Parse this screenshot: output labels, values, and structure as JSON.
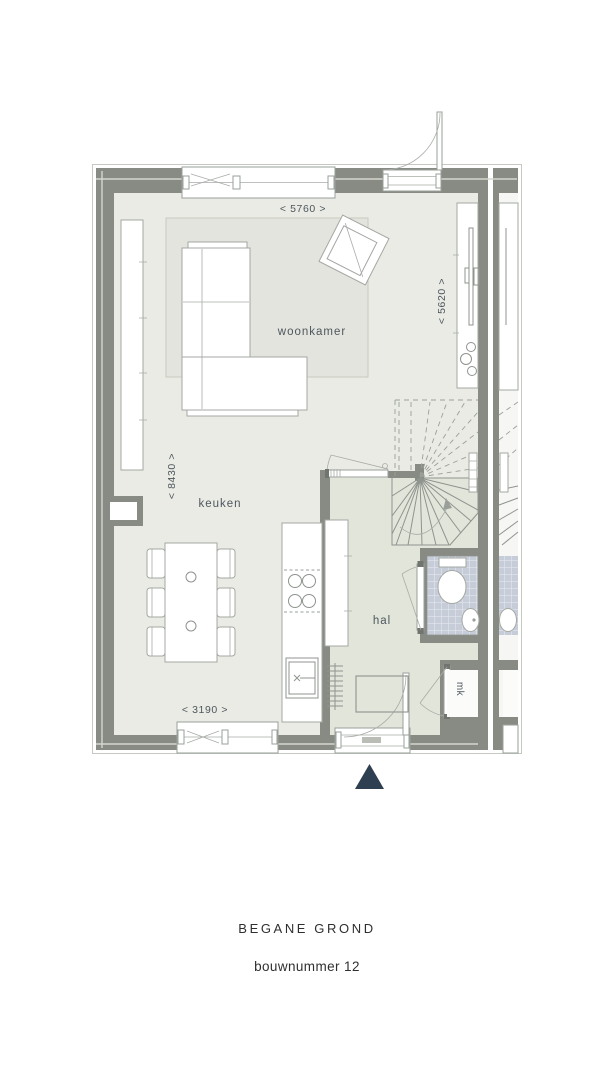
{
  "plan": {
    "room_labels": {
      "living_room": "woonkamer",
      "kitchen": "keuken",
      "hallway": "hal",
      "meter_closet": "mk"
    },
    "dimension_labels": {
      "top_width": "< 5760 >",
      "right_height": "< 5620 >",
      "left_height": "< 8430 >",
      "bottom_width": "< 3190 >"
    }
  },
  "footer": {
    "floor_name": "BEGANE GROND",
    "unit_number": "bouwnummer 12"
  },
  "colors": {
    "wall": "#888b83",
    "floor_main": "#eaebe4",
    "floor_hall": "#e2e5da",
    "rug": "#e3e4dd",
    "tile": "#c7ccd9",
    "tile_grout": "#e9ebf1",
    "neighbor_floor": "#f6f7f4",
    "entrance_marker": "#2e3f51",
    "label_text": "#4e575f",
    "footer_text": "#2f2f2f"
  }
}
